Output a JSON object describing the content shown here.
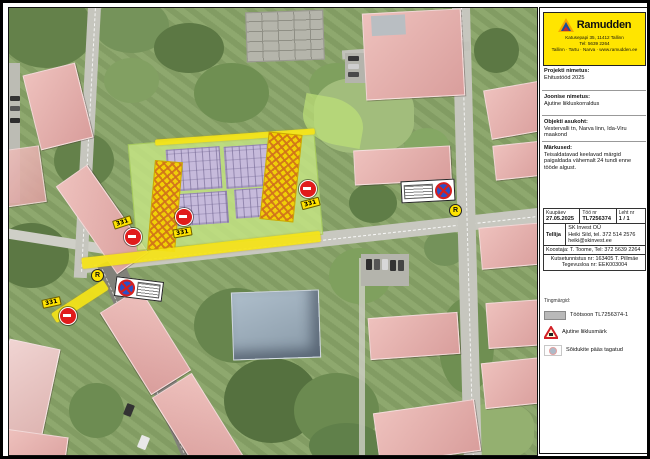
{
  "logo": {
    "brand": "Ramudden",
    "address_line1": "Katusepapi 35, 11412 Tallinn",
    "address_line2": "Tel: 5639 2264",
    "address_line3": "Tallinn · Tartu · Narva · www.ramudden.ee"
  },
  "fields": [
    {
      "label": "Projekti nimetus:",
      "value": "Ehitustööd 2025"
    },
    {
      "label": "Joonise nimetus:",
      "value": "Ajutine liikluskorraldus"
    },
    {
      "label": "Objekti asukoht:",
      "value": "Vestervalli tn, Narva linn, Ida-Viru maakond"
    },
    {
      "label": "Märkused:",
      "value": "Teisaldatavad keelavad märgid paigaldada vähemalt 24 tundi enne tööde algust."
    }
  ],
  "info_table": {
    "kuupaev_label": "Kuupäev",
    "kuupaev_value": "27.05.2025",
    "too_label": "Töö nr",
    "too_value": "TL7256374",
    "leht_label": "Leht nr",
    "leht_value": "1 / 1",
    "tellija_label": "Tellija",
    "tellija": {
      "line1": "SK Invest OÜ",
      "line2": "Heiki Sild, tel. 372 514 2576",
      "line3": "heiki@skinvest.ee"
    },
    "koostaja_line": "Koostaja: T. Toome, Tel: 372 5639 2264",
    "cert_line1": "Kutsetunnistus nr: 163405 T. Pillmäe",
    "cert_line2": "Tegevusloa nr: EEK003004"
  },
  "legend": {
    "title": "Tingmärgid:",
    "item1": "Töötsoon TL7256374-1",
    "item2": "Ajutine liiklusmärk",
    "item3": "Sõidukite pääs tagatud"
  },
  "map": {
    "sign_tag": "331",
    "r_label": "R"
  },
  "colors": {
    "brand_yellow": "#ffe500",
    "no_entry_red": "#e01b1b",
    "no_stopping_blue": "#2a50c8",
    "work_zone_green": "#c9e985",
    "hatch_yellow": "#f4d100",
    "parking_lavender": "#c6badb"
  }
}
